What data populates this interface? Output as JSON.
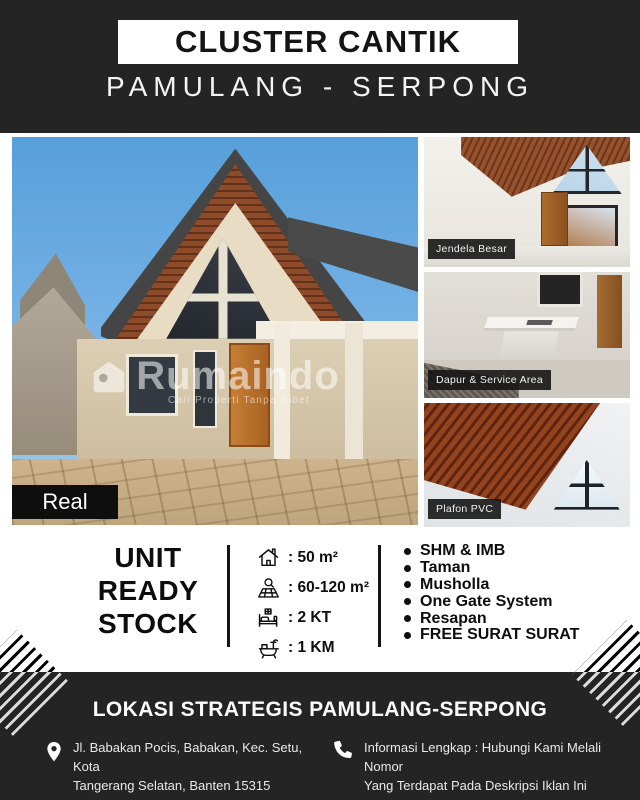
{
  "theme": {
    "background_dark": "#242424",
    "background_light": "#ffffff",
    "text_dark": "#0d0d0d",
    "text_light": "#f4f4f4",
    "sky_blue": "#6aaadf",
    "wood_brown": "#8e4b2a",
    "wall_cream": "#e9dcc4"
  },
  "header": {
    "title": "CLUSTER CANTIK",
    "subtitle": "PAMULANG - SERPONG"
  },
  "gallery": {
    "main_photo": {
      "badge": "Real",
      "watermark": {
        "logo_icon": "home-logo-icon",
        "brand": "Rumaindo",
        "tagline": "Cari Properti Tanpa Ribet"
      }
    },
    "side_photos": [
      {
        "label": "Jendela Besar"
      },
      {
        "label": "Dapur & Service Area"
      },
      {
        "label": "Plafon PVC"
      }
    ]
  },
  "specs": {
    "headline": [
      "UNIT",
      "READY",
      "STOCK"
    ],
    "items": [
      {
        "icon": "house-area-icon",
        "value": ": 50 m²"
      },
      {
        "icon": "land-area-icon",
        "value": ": 60-120 m²"
      },
      {
        "icon": "bed-icon",
        "value": ": 2 KT"
      },
      {
        "icon": "bath-icon",
        "value": ": 1 KM"
      }
    ],
    "features": [
      "SHM & IMB",
      "Taman",
      "Musholla",
      "One Gate System",
      "Resapan",
      "FREE SURAT SURAT"
    ]
  },
  "footer": {
    "headline": "LOKASI STRATEGIS PAMULANG-SERPONG",
    "address": {
      "icon": "location-pin-icon",
      "line1": "Jl. Babakan Pocis, Babakan, Kec. Setu, Kota",
      "line2": "Tangerang Selatan, Banten 15315"
    },
    "info": {
      "icon": "phone-icon",
      "line1": "Informasi Lengkap : Hubungi Kami Melali Nomor",
      "line2": "Yang Terdapat Pada Deskripsi Iklan Ini"
    }
  }
}
